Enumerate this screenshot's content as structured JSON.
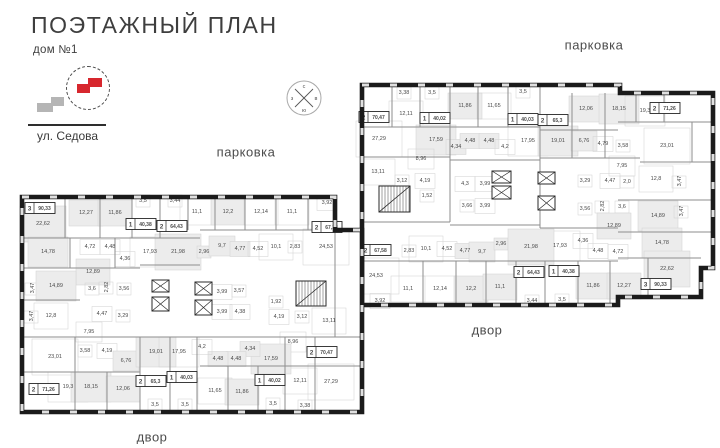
{
  "header": {
    "title": "ПОЭТАЖНЫЙ ПЛАН",
    "subtitle": "дом №1",
    "street_label": "ул. Седова"
  },
  "compass": {
    "letters": {
      "n": "с",
      "e": "в",
      "s": "ю",
      "w": "з"
    }
  },
  "colors": {
    "wall": "#1b1b1b",
    "thin_wall": "#8e8e8e",
    "room_stroke": "#d4d4d4",
    "room_fill": "#ececec",
    "window": "#e0e0e0",
    "accent_red": "#d7272e",
    "minimap_gray": "#b5b5b5",
    "text": "#4a4a4a"
  },
  "area_labels": [
    {
      "text": "парковка",
      "x": 594,
      "y": 45
    },
    {
      "text": "парковка",
      "x": 246,
      "y": 152
    },
    {
      "text": "двор",
      "x": 487,
      "y": 330
    },
    {
      "text": "двор",
      "x": 152,
      "y": 437
    }
  ],
  "buildings": [
    {
      "id": "building-upper",
      "outline": "M362,85 L620,85 L620,93 L713,93 L713,268 L701,268 L701,297 L618,297 L618,305 L362,305 Z",
      "walls": [
        [
          362,
          127,
          540,
          127
        ],
        [
          540,
          130,
          618,
          130
        ],
        [
          618,
          122,
          713,
          122
        ],
        [
          362,
          157,
          450,
          157
        ],
        [
          450,
          160,
          540,
          160
        ],
        [
          540,
          158,
          640,
          158
        ],
        [
          640,
          162,
          713,
          162
        ],
        [
          618,
          200,
          713,
          200
        ],
        [
          618,
          232,
          713,
          232
        ],
        [
          362,
          222,
          450,
          222
        ],
        [
          450,
          225,
          540,
          225
        ],
        [
          540,
          228,
          618,
          228
        ],
        [
          362,
          261,
          618,
          261
        ],
        [
          618,
          258,
          701,
          258
        ],
        [
          392,
          85,
          392,
          127
        ],
        [
          420,
          85,
          420,
          127
        ],
        [
          450,
          85,
          450,
          160
        ],
        [
          478,
          85,
          478,
          127
        ],
        [
          508,
          85,
          508,
          127
        ],
        [
          540,
          85,
          540,
          160
        ],
        [
          572,
          93,
          572,
          158
        ],
        [
          605,
          93,
          605,
          158
        ],
        [
          636,
          93,
          636,
          122
        ],
        [
          664,
          93,
          664,
          122
        ],
        [
          692,
          122,
          692,
          162
        ],
        [
          450,
          160,
          450,
          222
        ],
        [
          540,
          160,
          540,
          228
        ],
        [
          423,
          261,
          423,
          305
        ],
        [
          456,
          261,
          456,
          305
        ],
        [
          486,
          261,
          486,
          305
        ],
        [
          516,
          261,
          516,
          305
        ],
        [
          545,
          261,
          545,
          305
        ],
        [
          578,
          261,
          578,
          305
        ],
        [
          610,
          261,
          610,
          305
        ],
        [
          648,
          258,
          648,
          297
        ]
      ],
      "stairs": [
        {
          "x": 379,
          "y": 186,
          "w": 31,
          "h": 26
        }
      ],
      "elevators": [
        {
          "x": 492,
          "y": 171,
          "w": 19,
          "h": 12
        },
        {
          "x": 492,
          "y": 186,
          "w": 19,
          "h": 13
        },
        {
          "x": 538,
          "y": 172,
          "w": 17,
          "h": 12
        },
        {
          "x": 538,
          "y": 196,
          "w": 17,
          "h": 14
        }
      ],
      "badges": [
        {
          "n": "2",
          "a": "70,47",
          "x": 374,
          "y": 117
        },
        {
          "n": "1",
          "a": "40,02",
          "x": 435,
          "y": 118
        },
        {
          "n": "1",
          "a": "40,03",
          "x": 523,
          "y": 119
        },
        {
          "n": "2",
          "a": "65,3",
          "x": 553,
          "y": 120
        },
        {
          "n": "2",
          "a": "71,26",
          "x": 665,
          "y": 108
        },
        {
          "n": "2",
          "a": "67,58",
          "x": 376,
          "y": 250
        },
        {
          "n": "2",
          "a": "64,43",
          "x": 529,
          "y": 272
        },
        {
          "n": "1",
          "a": "40,38",
          "x": 564,
          "y": 271
        },
        {
          "n": "3",
          "a": "90,33",
          "x": 656,
          "y": 284
        }
      ],
      "rooms": [
        [
          "3,38",
          404,
          92
        ],
        [
          "3,5",
          432,
          92
        ],
        [
          "11,86",
          465,
          105,
          "s"
        ],
        [
          "11,65",
          494,
          105
        ],
        [
          "3,5",
          523,
          91
        ],
        [
          "12,11",
          406,
          113
        ],
        [
          "27,29",
          379,
          138
        ],
        [
          "17,59",
          436,
          139,
          "s"
        ],
        [
          "4,34",
          456,
          146,
          "s"
        ],
        [
          "4,48",
          470,
          140,
          "s"
        ],
        [
          "4,48",
          489,
          140,
          "s"
        ],
        [
          "4,2",
          505,
          146
        ],
        [
          "17,95",
          528,
          140
        ],
        [
          "8,96",
          421,
          158
        ],
        [
          "13,11",
          378,
          171
        ],
        [
          "3,12",
          402,
          180
        ],
        [
          "4,19",
          425,
          180
        ],
        [
          "1,52",
          427,
          195
        ],
        [
          "4,3",
          465,
          183
        ],
        [
          "3,99",
          485,
          183
        ],
        [
          "3,66",
          467,
          205
        ],
        [
          "3,99",
          485,
          205
        ],
        [
          "12,06",
          586,
          108,
          "s"
        ],
        [
          "18,15",
          619,
          108,
          "s"
        ],
        [
          "19,3",
          645,
          110
        ],
        [
          "19,01",
          558,
          140,
          "s"
        ],
        [
          "6,76",
          584,
          140,
          "s"
        ],
        [
          "4,79",
          603,
          143
        ],
        [
          "3,58",
          623,
          145
        ],
        [
          "23,01",
          667,
          145
        ],
        [
          "7,95",
          622,
          165
        ],
        [
          "3,29",
          585,
          180
        ],
        [
          "4,47",
          610,
          180
        ],
        [
          "2,0",
          627,
          181
        ],
        [
          "12,8",
          656,
          178
        ],
        [
          "3,47",
          679,
          181,
          "r"
        ],
        [
          "3,56",
          585,
          208
        ],
        [
          "2,82",
          602,
          206,
          "r"
        ],
        [
          "3,6",
          622,
          206
        ],
        [
          "14,89",
          658,
          215,
          "s"
        ],
        [
          "3,47",
          681,
          211,
          "r"
        ],
        [
          "12,89",
          614,
          225,
          "s"
        ],
        [
          "17,93",
          560,
          245
        ],
        [
          "4,36",
          583,
          240
        ],
        [
          "4,48",
          598,
          250
        ],
        [
          "4,72",
          618,
          251
        ],
        [
          "14,78",
          662,
          242,
          "s"
        ],
        [
          "22,62",
          667,
          268,
          "s"
        ],
        [
          "2,83",
          409,
          250
        ],
        [
          "10,1",
          426,
          248
        ],
        [
          "4,52",
          447,
          248
        ],
        [
          "4,77",
          465,
          250,
          "s"
        ],
        [
          "9,7",
          482,
          251,
          "s"
        ],
        [
          "2,96",
          501,
          243,
          "s"
        ],
        [
          "21,98",
          531,
          246,
          "s"
        ],
        [
          "24,53",
          376,
          275
        ],
        [
          "11,1",
          408,
          288
        ],
        [
          "12,14",
          440,
          288
        ],
        [
          "12,2",
          471,
          288,
          "s"
        ],
        [
          "11,1",
          500,
          286,
          "s"
        ],
        [
          "3,92",
          380,
          300
        ],
        [
          "3,44",
          532,
          300
        ],
        [
          "11,86",
          593,
          285,
          "s"
        ],
        [
          "12,27",
          624,
          285,
          "s"
        ],
        [
          "3,5",
          562,
          299
        ]
      ]
    },
    {
      "id": "building-lower",
      "outline": "M22,197 L335,197 L335,230 L362,230 L362,412 L22,412 Z",
      "walls": [
        [
          22,
          238,
          200,
          238
        ],
        [
          200,
          230,
          335,
          230
        ],
        [
          22,
          268,
          140,
          268
        ],
        [
          22,
          300,
          80,
          300
        ],
        [
          22,
          337,
          362,
          337
        ],
        [
          22,
          372,
          140,
          372
        ],
        [
          200,
          366,
          362,
          366
        ],
        [
          140,
          265,
          200,
          265
        ],
        [
          65,
          197,
          65,
          238
        ],
        [
          100,
          197,
          100,
          238
        ],
        [
          132,
          197,
          132,
          238
        ],
        [
          160,
          197,
          160,
          238
        ],
        [
          188,
          197,
          188,
          230
        ],
        [
          215,
          197,
          215,
          230
        ],
        [
          245,
          197,
          245,
          230
        ],
        [
          276,
          197,
          276,
          230
        ],
        [
          308,
          197,
          308,
          230
        ],
        [
          70,
          238,
          70,
          268
        ],
        [
          115,
          238,
          115,
          268
        ],
        [
          75,
          337,
          75,
          412
        ],
        [
          107,
          372,
          107,
          412
        ],
        [
          140,
          337,
          140,
          412
        ],
        [
          170,
          337,
          170,
          412
        ],
        [
          197,
          337,
          197,
          412
        ],
        [
          228,
          366,
          228,
          412
        ],
        [
          258,
          366,
          258,
          412
        ],
        [
          285,
          337,
          285,
          412
        ],
        [
          315,
          337,
          315,
          412
        ],
        [
          335,
          230,
          335,
          337
        ]
      ],
      "stairs": [
        {
          "x": 296,
          "y": 281,
          "w": 30,
          "h": 25
        }
      ],
      "elevators": [
        {
          "x": 152,
          "y": 280,
          "w": 17,
          "h": 12
        },
        {
          "x": 152,
          "y": 297,
          "w": 17,
          "h": 14
        },
        {
          "x": 195,
          "y": 282,
          "w": 17,
          "h": 13
        },
        {
          "x": 195,
          "y": 300,
          "w": 17,
          "h": 15
        }
      ],
      "badges": [
        {
          "n": "3",
          "a": "90,33",
          "x": 40,
          "y": 208
        },
        {
          "n": "1",
          "a": "40,38",
          "x": 141,
          "y": 224
        },
        {
          "n": "2",
          "a": "64,43",
          "x": 172,
          "y": 226
        },
        {
          "n": "2",
          "a": "67,18",
          "x": 327,
          "y": 227
        },
        {
          "n": "2",
          "a": "71,26",
          "x": 44,
          "y": 389
        },
        {
          "n": "2",
          "a": "65,3",
          "x": 151,
          "y": 381
        },
        {
          "n": "1",
          "a": "40,03",
          "x": 182,
          "y": 377
        },
        {
          "n": "1",
          "a": "40,02",
          "x": 270,
          "y": 380
        },
        {
          "n": "2",
          "a": "70,47",
          "x": 322,
          "y": 352
        }
      ],
      "rooms": [
        [
          "3,5",
          143,
          200
        ],
        [
          "3,44",
          175,
          200
        ],
        [
          "11,1",
          197,
          211
        ],
        [
          "12,2",
          228,
          211,
          "s"
        ],
        [
          "12,14",
          261,
          211
        ],
        [
          "11,1",
          292,
          211
        ],
        [
          "3,92",
          327,
          202
        ],
        [
          "22,62",
          43,
          223,
          "s"
        ],
        [
          "12,27",
          86,
          212,
          "s"
        ],
        [
          "11,86",
          115,
          212,
          "s"
        ],
        [
          "14,78",
          48,
          251,
          "s"
        ],
        [
          "4,72",
          90,
          246
        ],
        [
          "4,48",
          110,
          246
        ],
        [
          "4,36",
          125,
          258
        ],
        [
          "17,93",
          150,
          251
        ],
        [
          "21,98",
          178,
          251,
          "s"
        ],
        [
          "2,96",
          204,
          251,
          "s"
        ],
        [
          "9,7",
          222,
          245,
          "s"
        ],
        [
          "4,77",
          240,
          248,
          "s"
        ],
        [
          "4,52",
          258,
          248
        ],
        [
          "10,1",
          276,
          246
        ],
        [
          "2,83",
          295,
          246
        ],
        [
          "24,53",
          326,
          246
        ],
        [
          "12,89",
          93,
          271,
          "s"
        ],
        [
          "3,47",
          32,
          288,
          "r"
        ],
        [
          "14,89",
          56,
          285,
          "s"
        ],
        [
          "3,6",
          92,
          288
        ],
        [
          "2,82",
          106,
          287,
          "r"
        ],
        [
          "3,56",
          124,
          288
        ],
        [
          "3,47",
          31,
          316,
          "r"
        ],
        [
          "12,8",
          51,
          315
        ],
        [
          "4,47",
          102,
          313
        ],
        [
          "3,29",
          123,
          315
        ],
        [
          "7,95",
          89,
          331
        ],
        [
          "3,99",
          222,
          291
        ],
        [
          "3,57",
          239,
          290
        ],
        [
          "3,99",
          222,
          311
        ],
        [
          "4,38",
          240,
          311
        ],
        [
          "1,92",
          276,
          301
        ],
        [
          "4,19",
          279,
          316
        ],
        [
          "3,12",
          302,
          316
        ],
        [
          "13,11",
          329,
          320
        ],
        [
          "23,01",
          55,
          356
        ],
        [
          "3,58",
          85,
          350
        ],
        [
          "4,19",
          107,
          350
        ],
        [
          "6,76",
          126,
          360,
          "s"
        ],
        [
          "19,01",
          156,
          351,
          "s"
        ],
        [
          "17,95",
          179,
          351
        ],
        [
          "19,3",
          68,
          386
        ],
        [
          "18,15",
          91,
          386,
          "s"
        ],
        [
          "12,06",
          123,
          388,
          "s"
        ],
        [
          "11,65",
          215,
          390
        ],
        [
          "11,86",
          242,
          391,
          "s"
        ],
        [
          "12,11",
          300,
          380
        ],
        [
          "27,29",
          331,
          381
        ],
        [
          "3,5",
          155,
          404
        ],
        [
          "3,5",
          185,
          404
        ],
        [
          "3,5",
          273,
          403
        ],
        [
          "3,38",
          305,
          405
        ],
        [
          "8,96",
          293,
          341
        ],
        [
          "17,59",
          271,
          358,
          "s"
        ],
        [
          "4,34",
          250,
          348,
          "s"
        ],
        [
          "4,48",
          236,
          358,
          "s"
        ],
        [
          "4,48",
          218,
          358,
          "s"
        ],
        [
          "4,2",
          202,
          346
        ]
      ]
    }
  ]
}
